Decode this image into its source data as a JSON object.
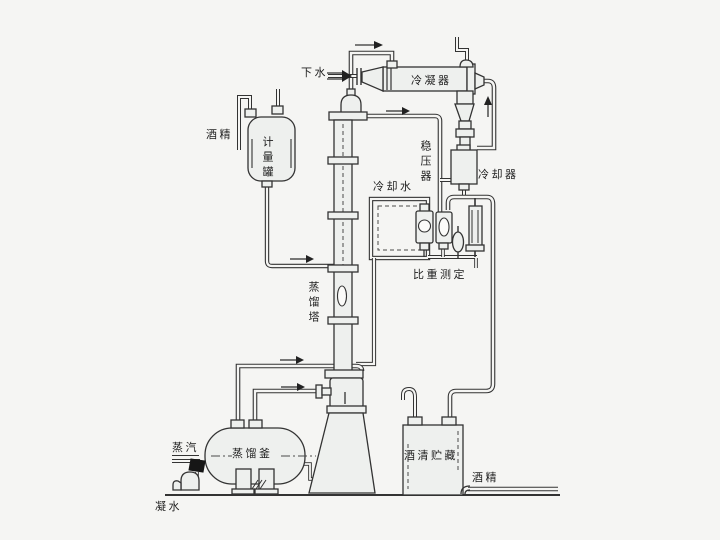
{
  "diagram": {
    "title": "alcohol distillation process flow diagram",
    "labels": {
      "drain_water": "下水",
      "condenser": "冷凝器",
      "alcohol_in": "酒精",
      "measuring_tank": "计量罐",
      "pressure_stabilizer": "稳压器",
      "cooling_water": "冷却水",
      "cooler": "冷却器",
      "specific_gravity_measurement": "比重测定",
      "distillation_column": "蒸馏塔",
      "steam": "蒸汽",
      "distillation_pot": "蒸馏釜",
      "alcohol_storage": "酒清贮藏",
      "alcohol_out": "酒精",
      "condensate_water": "凝水"
    },
    "colors": {
      "background": "#f5f5f3",
      "line": "#333333",
      "vessel_fill": "#eef0ee",
      "text": "#1f1f1f"
    }
  }
}
